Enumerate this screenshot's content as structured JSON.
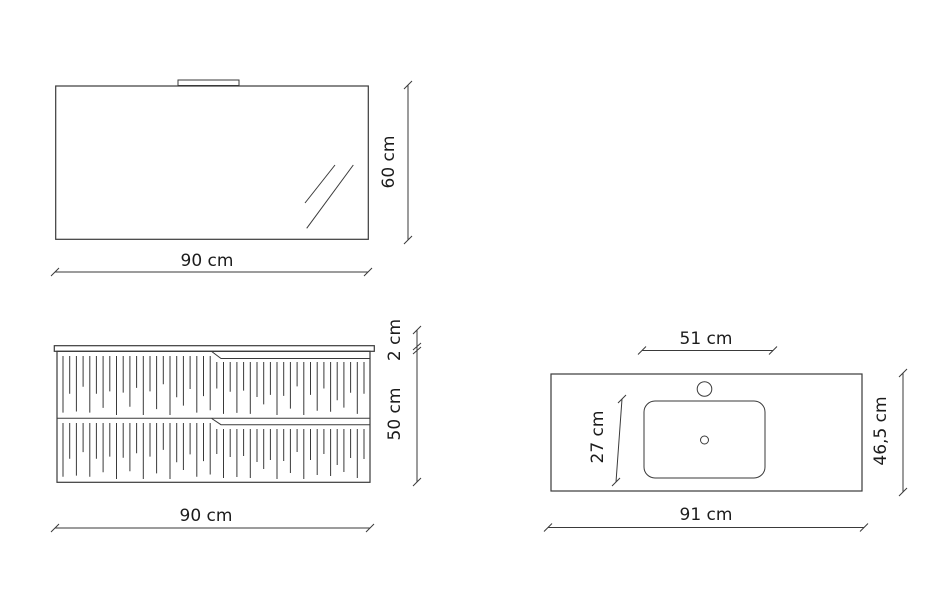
{
  "drawing": {
    "type": "bathroom-furniture-technical-drawing",
    "units": "cm"
  },
  "colors": {
    "line": "#3a3a3a",
    "text": "#1c1c1c",
    "background": "#ffffff"
  },
  "mirror": {
    "width_label": "90 cm",
    "height_label": "60 cm"
  },
  "cabinet": {
    "width_label": "90 cm",
    "height_label": "50 cm",
    "top_thickness_label": "2 cm"
  },
  "washbasin": {
    "width_label": "91 cm",
    "depth_label": "46,5 cm",
    "basin_width_label": "51 cm",
    "basin_depth_label": "27 cm"
  }
}
